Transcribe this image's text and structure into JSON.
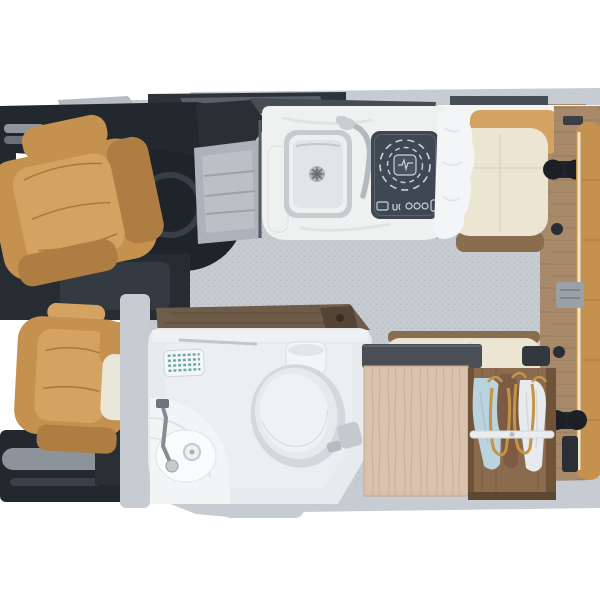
{
  "scene": {
    "type": "3d-rendered-overhead-cutaway",
    "subject": "camper van interior floor plan, top-down view, cab at left, living area at right",
    "background": "#ffffff"
  },
  "objects": {
    "cab": [
      "dashboard",
      "passenger-swivel-seat",
      "driver-swivel-seat",
      "door-panel",
      "entry-step"
    ],
    "kitchen": [
      "marble-counter",
      "stainless-sink",
      "faucet",
      "induction-hob",
      "window-strip"
    ],
    "dinette": [
      "white-shelf",
      "upper-bench",
      "lower-bench",
      "sheepskin-throw",
      "table-leg-mount"
    ],
    "bathroom": [
      "wood-countertop",
      "towel-bar",
      "vent-grille",
      "toilet",
      "toilet-paper-roll",
      "corner-shower-basin",
      "shower-faucet"
    ],
    "wardrobe": [
      "cabinet-top",
      "hanging-rail",
      "garments",
      "hangers"
    ],
    "rear": [
      "lengthwise-bench-seat",
      "wood-floor-strip",
      "seat-anchors"
    ]
  },
  "palette": {
    "background": "#ffffff",
    "body_shell_gray": "#c7cbd2",
    "floor_gray": "#c7ccd3",
    "dash_dark": "#23272e",
    "console_dark": "#1f242b",
    "track_dark": "#2e333a",
    "step_metal": "#abb2b9",
    "leather_tan": "#c5914f",
    "leather_tan_light": "#d4a361",
    "leather_tan_dark": "#ad7d41",
    "cream_upholstery": "#ebe5d1",
    "counter_marble": "#eff1f0",
    "sink_steel": "#c6cbcf",
    "sink_basin": "#e1e5e6",
    "hob_dark": "#3f4753",
    "hob_markings": "#ccd1d8",
    "window_dark": "#474d55",
    "shelf_white": "#f3f4f4",
    "wood_mid": "#a8896a",
    "wood_trim_dark": "#8a6c50",
    "wood_dark": "#6f5b49",
    "wood_light": "#d8c1ad",
    "wardrobe_interior": "#8b6b4d",
    "bath_wall": "#e7ebee",
    "bath_fixture": "#eff2f4",
    "vent_teal": "#68a9a3",
    "chrome": "#b4b9bf",
    "blanket_white": "#f4f5f6",
    "garment_blue": "#b9d4de",
    "garment_brown": "#7c5a43",
    "garment_white": "#e8ebee",
    "hanger_tan": "#c49547",
    "anchor_dark": "#22262c",
    "armrest_gray": "#8d939a"
  }
}
